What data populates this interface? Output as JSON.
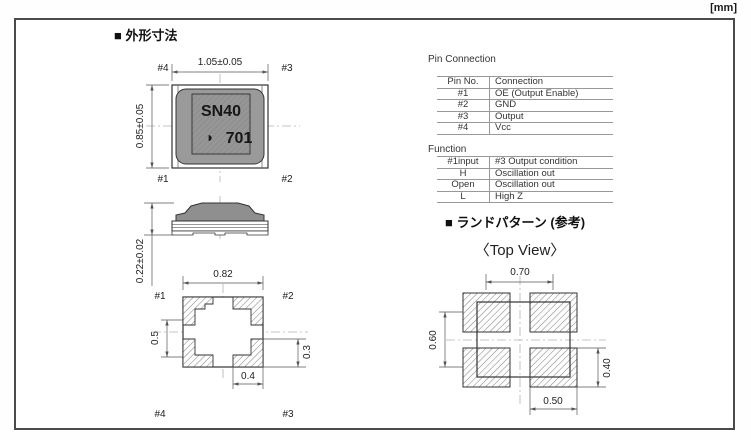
{
  "units_label": "[mm]",
  "outline": {
    "heading": "■ 外形寸法",
    "top_view": {
      "dim_width": "1.05±0.05",
      "dim_height": "0.85±0.05",
      "pin_tl": "#4",
      "pin_tr": "#3",
      "pin_bl": "#1",
      "pin_br": "#2",
      "marking_line1": "SN40",
      "marking_line2": "701",
      "logo_glyph": "◗"
    },
    "side_view": {
      "dim_height": "0.22±0.02"
    },
    "bottom_view": {
      "dim_width": "0.82",
      "dim_left": "0.5",
      "dim_right": "0.3",
      "dim_pad": "0.4",
      "pin_tl": "#1",
      "pin_tr": "#2",
      "pin_bl": "#4",
      "pin_br": "#3"
    }
  },
  "tables": {
    "pin_connection": {
      "title": "Pin Connection",
      "headers": [
        "Pin No.",
        "Connection"
      ],
      "rows": [
        [
          "#1",
          "OE (Output Enable)"
        ],
        [
          "#2",
          "GND"
        ],
        [
          "#3",
          "Output"
        ],
        [
          "#4",
          "Vcc"
        ]
      ]
    },
    "function": {
      "title": "Function",
      "headers": [
        "#1input",
        "#3 Output condition"
      ],
      "rows": [
        [
          "H",
          "Oscillation out"
        ],
        [
          "Open",
          "Oscillation out"
        ],
        [
          "L",
          "High Z"
        ]
      ]
    }
  },
  "land_pattern": {
    "heading": "■ ランドパターン (参考)",
    "subheading": "〈Top View〉",
    "dim_top": "0.70",
    "dim_left": "0.60",
    "dim_right": "0.40",
    "dim_bottom": "0.50"
  },
  "colors": {
    "frame_border": "#4a4a4a",
    "body_gray": "#9a9a9a",
    "lid_gray": "#8f8f8f",
    "drawing_line": "#333333",
    "dimension_line": "#555555",
    "table_line": "#999999",
    "centerline": "#b3b3b3",
    "hatch": "#808080"
  }
}
